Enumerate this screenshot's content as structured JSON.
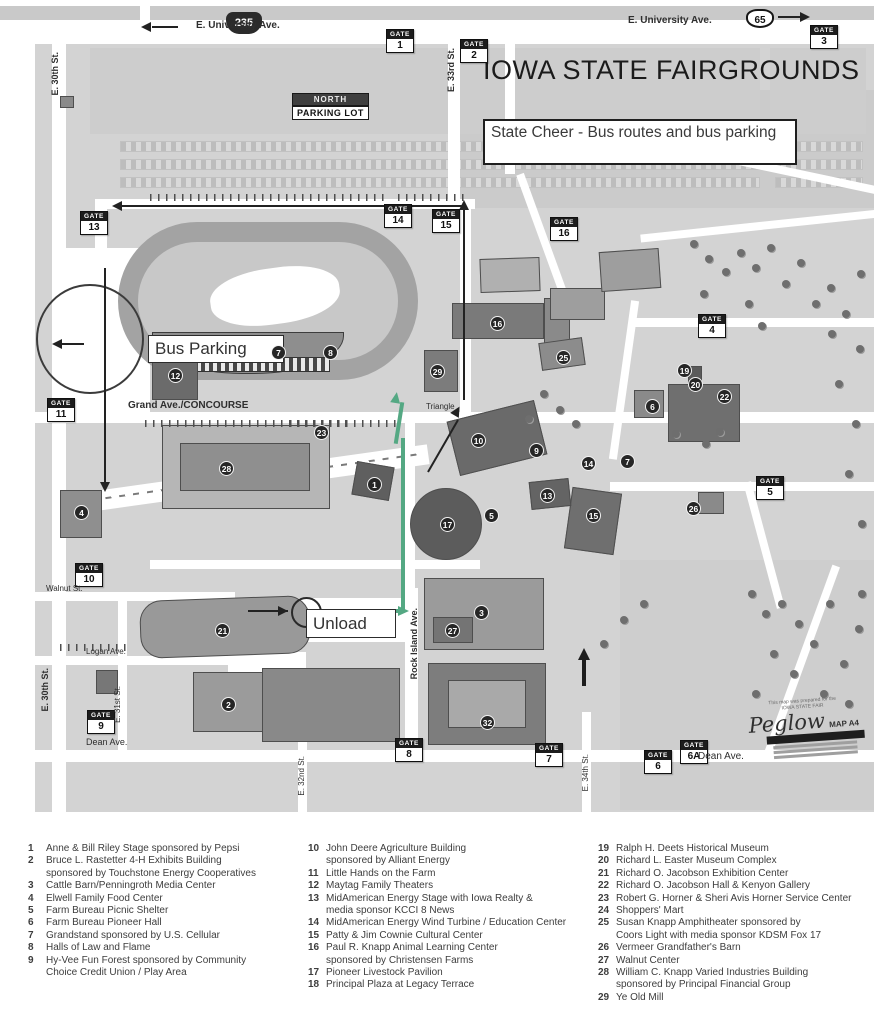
{
  "map": {
    "title": "IOWA STATE FAIRGROUNDS",
    "subtitle": "State Cheer - Bus routes and bus parking",
    "gate_word": "GATE",
    "labels": {
      "bus_parking": "Bus Parking",
      "unload": "Unload",
      "north_lot_line1": "NORTH",
      "north_lot_line2": "PARKING LOT",
      "triangle": "Triangle"
    },
    "shields": {
      "interstate": "235",
      "us": "65"
    },
    "colors": {
      "route_green": "#54a883",
      "map_gray": "#d3d3d3",
      "building_gray": "#9a9a9a",
      "ink": "#222222"
    },
    "gates": [
      {
        "n": "1",
        "x": 386,
        "y": 29
      },
      {
        "n": "2",
        "x": 460,
        "y": 39
      },
      {
        "n": "3",
        "x": 810,
        "y": 25
      },
      {
        "n": "13",
        "x": 80,
        "y": 211
      },
      {
        "n": "14",
        "x": 384,
        "y": 204
      },
      {
        "n": "15",
        "x": 432,
        "y": 209
      },
      {
        "n": "16",
        "x": 550,
        "y": 217
      },
      {
        "n": "4",
        "x": 698,
        "y": 314
      },
      {
        "n": "5",
        "x": 756,
        "y": 476
      },
      {
        "n": "11",
        "x": 47,
        "y": 398
      },
      {
        "n": "10",
        "x": 75,
        "y": 563
      },
      {
        "n": "9",
        "x": 87,
        "y": 710
      },
      {
        "n": "8",
        "x": 395,
        "y": 738
      },
      {
        "n": "7",
        "x": 535,
        "y": 743
      },
      {
        "n": "6",
        "x": 644,
        "y": 750
      },
      {
        "n": "6A",
        "x": 680,
        "y": 740
      }
    ],
    "markers": [
      {
        "n": "1",
        "x": 374,
        "y": 484
      },
      {
        "n": "2",
        "x": 228,
        "y": 704
      },
      {
        "n": "3",
        "x": 481,
        "y": 612
      },
      {
        "n": "4",
        "x": 81,
        "y": 512
      },
      {
        "n": "5",
        "x": 491,
        "y": 515
      },
      {
        "n": "6",
        "x": 652,
        "y": 406
      },
      {
        "n": "7",
        "x": 278,
        "y": 352
      },
      {
        "n": "8",
        "x": 330,
        "y": 352
      },
      {
        "n": "9",
        "x": 536,
        "y": 450
      },
      {
        "n": "10",
        "x": 478,
        "y": 440
      },
      {
        "n": "12",
        "x": 175,
        "y": 375
      },
      {
        "n": "13",
        "x": 547,
        "y": 495
      },
      {
        "n": "14",
        "x": 588,
        "y": 463
      },
      {
        "n": "15",
        "x": 593,
        "y": 515
      },
      {
        "n": "16",
        "x": 497,
        "y": 323
      },
      {
        "n": "17",
        "x": 447,
        "y": 524
      },
      {
        "n": "19",
        "x": 684,
        "y": 370
      },
      {
        "n": "20",
        "x": 695,
        "y": 384
      },
      {
        "n": "21",
        "x": 222,
        "y": 630
      },
      {
        "n": "22",
        "x": 724,
        "y": 396
      },
      {
        "n": "23",
        "x": 321,
        "y": 432
      },
      {
        "n": "25",
        "x": 563,
        "y": 357
      },
      {
        "n": "26",
        "x": 693,
        "y": 508
      },
      {
        "n": "27",
        "x": 452,
        "y": 630
      },
      {
        "n": "28",
        "x": 226,
        "y": 468
      },
      {
        "n": "29",
        "x": 437,
        "y": 371
      },
      {
        "n": "7",
        "x": 627,
        "y": 461
      },
      {
        "n": "32",
        "x": 487,
        "y": 722
      }
    ],
    "street_labels": [
      {
        "t": "E. University Ave.",
        "x": 196,
        "y": 20,
        "v": 0,
        "s": 10,
        "b": 1
      },
      {
        "t": "E. University Ave.",
        "x": 628,
        "y": 15,
        "v": 0,
        "s": 10,
        "b": 1
      },
      {
        "t": "E. 30th St.",
        "x": 50,
        "y": 52,
        "v": 1,
        "s": 9,
        "b": 1
      },
      {
        "t": "E. 30th St.",
        "x": 40,
        "y": 668,
        "v": 1,
        "s": 9,
        "b": 1
      },
      {
        "t": "E. 33rd St.",
        "x": 446,
        "y": 48,
        "v": 1,
        "s": 9,
        "b": 1
      },
      {
        "t": "E. 31st St.",
        "x": 113,
        "y": 686,
        "v": 1,
        "s": 8,
        "b": 0
      },
      {
        "t": "E. 32nd St.",
        "x": 297,
        "y": 756,
        "v": 1,
        "s": 8,
        "b": 0
      },
      {
        "t": "E. 34th St.",
        "x": 581,
        "y": 754,
        "v": 1,
        "s": 8,
        "b": 0
      },
      {
        "t": "Rock Island Ave.",
        "x": 409,
        "y": 608,
        "v": 1,
        "s": 9,
        "b": 1
      },
      {
        "t": "Grand Ave./CONCOURSE",
        "x": 128,
        "y": 400,
        "v": 0,
        "s": 10,
        "b": 1
      },
      {
        "t": "Walnut St.",
        "x": 46,
        "y": 584,
        "v": 0,
        "s": 8,
        "b": 0
      },
      {
        "t": "Logan Ave.",
        "x": 86,
        "y": 647,
        "v": 0,
        "s": 8,
        "b": 0
      },
      {
        "t": "Dean Ave.",
        "x": 86,
        "y": 737,
        "v": 0,
        "s": 9,
        "b": 0
      },
      {
        "t": "Dean Ave.",
        "x": 698,
        "y": 751,
        "v": 0,
        "s": 10,
        "b": 0
      },
      {
        "t": "Triangle",
        "x": 426,
        "y": 402,
        "v": 0,
        "s": 8,
        "b": 0
      }
    ],
    "credit": {
      "line1": "This map was prepared for the",
      "line2": "IOWA STATE FAIR",
      "logo": "Peglow",
      "map_ref": "MAP A4"
    }
  },
  "legend": {
    "columns": [
      [
        {
          "num": "1",
          "text": "Anne & Bill Riley Stage sponsored by Pepsi"
        },
        {
          "num": "2",
          "text": "Bruce L. Rastetter 4-H Exhibits Building",
          "text2": "sponsored by Touchstone Energy Cooperatives"
        },
        {
          "num": "3",
          "text": "Cattle Barn/Penningroth Media Center"
        },
        {
          "num": "4",
          "text": "Elwell Family Food Center"
        },
        {
          "num": "5",
          "text": "Farm Bureau Picnic Shelter"
        },
        {
          "num": "6",
          "text": "Farm Bureau Pioneer Hall"
        },
        {
          "num": "7",
          "text": "Grandstand sponsored by U.S. Cellular"
        },
        {
          "num": "8",
          "text": "Halls of Law and Flame"
        },
        {
          "num": "9",
          "text": "Hy-Vee Fun Forest sponsored by Community",
          "text2": "Choice Credit Union / Play Area"
        }
      ],
      [
        {
          "num": "10",
          "text": "John Deere Agriculture Building",
          "text2": "sponsored by Alliant Energy"
        },
        {
          "num": "11",
          "text": "Little Hands on the Farm"
        },
        {
          "num": "12",
          "text": "Maytag Family Theaters"
        },
        {
          "num": "13",
          "text": "MidAmerican Energy Stage with Iowa Realty &",
          "text2": "media sponsor KCCI 8 News"
        },
        {
          "num": "14",
          "text": "MidAmerican Energy Wind Turbine / Education Center"
        },
        {
          "num": "15",
          "text": "Patty & Jim Cownie Cultural Center"
        },
        {
          "num": "16",
          "text": "Paul R. Knapp Animal Learning Center",
          "text2": "sponsored by Christensen Farms"
        },
        {
          "num": "17",
          "text": "Pioneer Livestock Pavilion"
        },
        {
          "num": "18",
          "text": "Principal Plaza at Legacy Terrace"
        }
      ],
      [
        {
          "num": "19",
          "text": "Ralph H. Deets Historical Museum"
        },
        {
          "num": "20",
          "text": "Richard L. Easter Museum Complex"
        },
        {
          "num": "21",
          "text": "Richard O. Jacobson Exhibition Center"
        },
        {
          "num": "22",
          "text": "Richard O. Jacobson Hall & Kenyon Gallery"
        },
        {
          "num": "23",
          "text": "Robert G. Horner & Sheri Avis Horner Service Center"
        },
        {
          "num": "24",
          "text": "Shoppers' Mart"
        },
        {
          "num": "25",
          "text": "Susan Knapp Amphitheater sponsored by",
          "text2": "Coors Light with media sponsor KDSM Fox 17"
        },
        {
          "num": "26",
          "text": "Vermeer Grandfather's Barn"
        },
        {
          "num": "27",
          "text": "Walnut Center"
        },
        {
          "num": "28",
          "text": "William C. Knapp Varied Industries Building",
          "text2": "sponsored by Principal Financial Group"
        },
        {
          "num": "29",
          "text": "Ye Old Mill"
        }
      ]
    ]
  }
}
